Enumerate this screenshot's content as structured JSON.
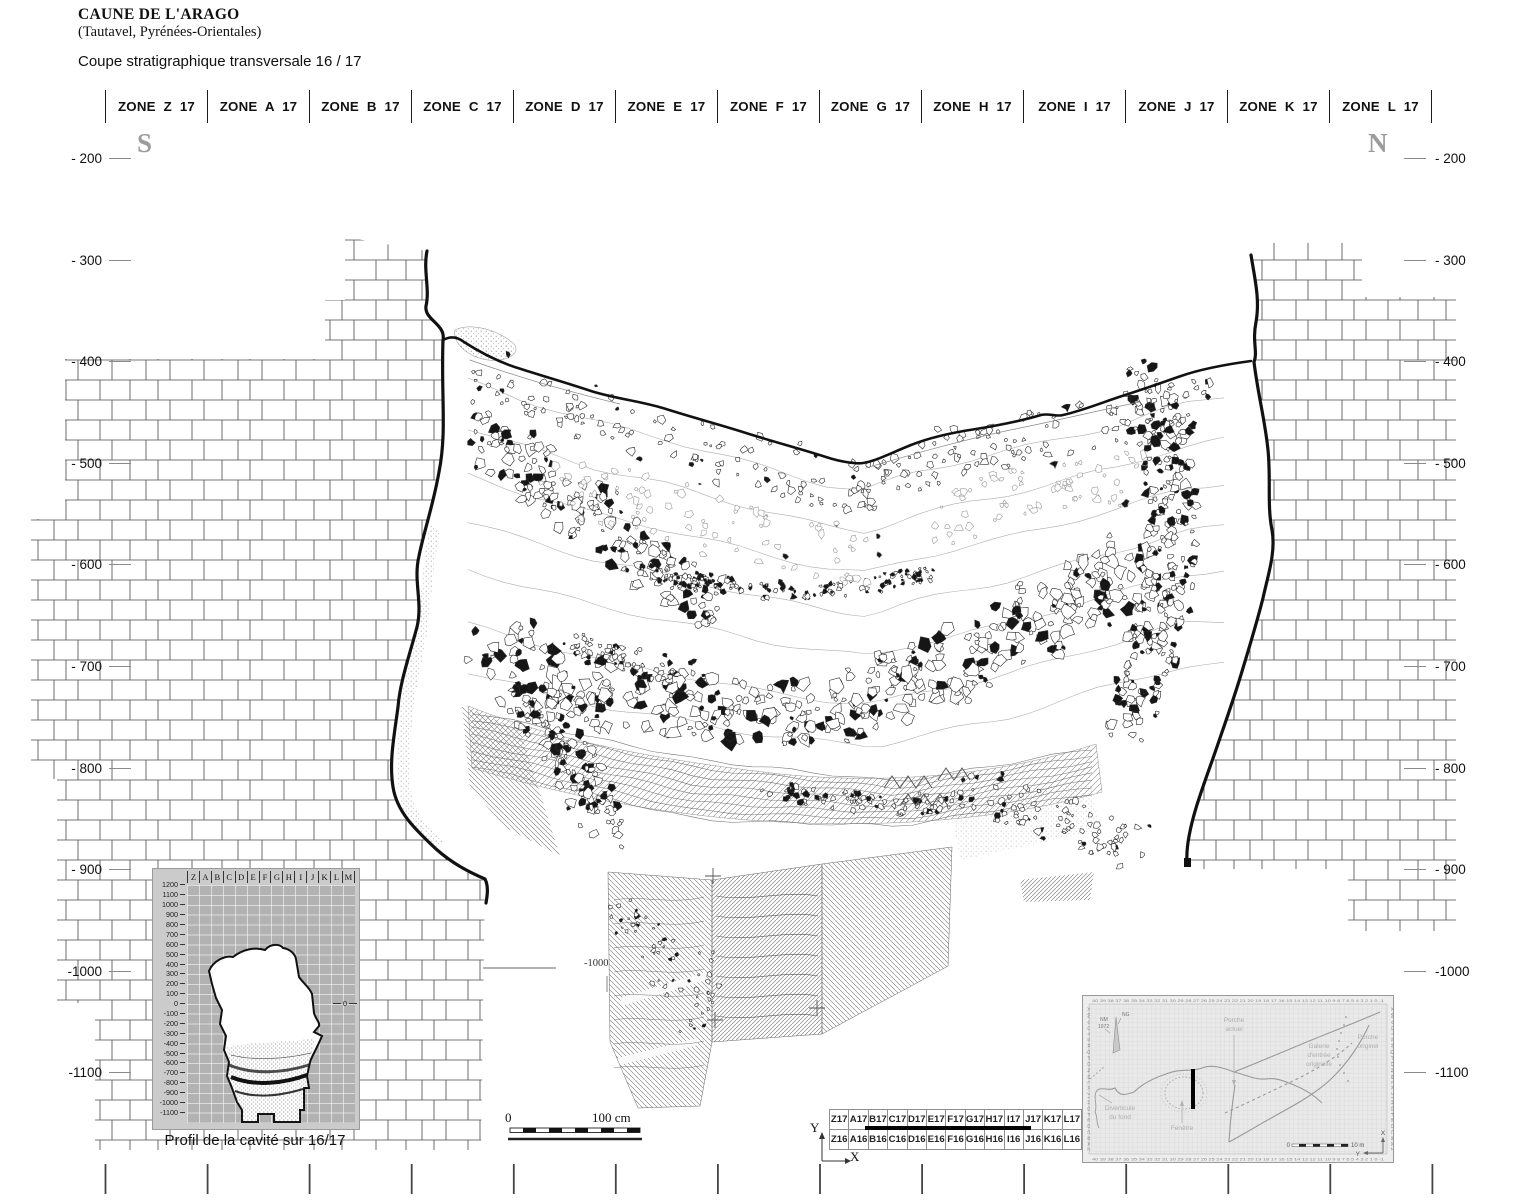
{
  "header": {
    "title": "CAUNE DE L'ARAGO",
    "subtitle": "(Tautavel, Pyrénées-Orientales)",
    "caption": "Coupe stratigraphique transversale 16 / 17"
  },
  "compass": {
    "south": "S",
    "north": "N"
  },
  "zones": [
    "ZONE Z 17",
    "ZONE A 17",
    "ZONE B 17",
    "ZONE C 17",
    "ZONE D 17",
    "ZONE E 17",
    "ZONE F 17",
    "ZONE G 17",
    "ZONE H 17",
    "ZONE I 17",
    "ZONE J 17",
    "ZONE K 17",
    "ZONE L 17"
  ],
  "depth_scale": {
    "labels": [
      "- 200",
      "- 300",
      "- 400",
      "- 500",
      "- 600",
      "- 700",
      "- 800",
      "- 900",
      "-1000",
      "-1100"
    ]
  },
  "section": {
    "inner_label": "-1000"
  },
  "profile_inset": {
    "caption": "Profil de la cavité sur 16/17",
    "column_letters": [
      "Z",
      "A",
      "B",
      "C",
      "D",
      "E",
      "F",
      "G",
      "H",
      "I",
      "J",
      "K",
      "L",
      "M"
    ],
    "row_labels": [
      "1200",
      "1100",
      "1000",
      "900",
      "800",
      "700",
      "600",
      "500",
      "400",
      "300",
      "200",
      "100",
      "0",
      "-100",
      "-200",
      "-300",
      "-400",
      "-500",
      "-600",
      "-700",
      "-800",
      "-900",
      "-1000",
      "-1100"
    ],
    "zero_marker": "0"
  },
  "scale_bar": {
    "start": "0",
    "end": "100 cm"
  },
  "grid_table": {
    "row1": [
      "Z17",
      "A17",
      "B17",
      "C17",
      "D17",
      "E17",
      "F17",
      "G17",
      "H17",
      "I17",
      "J17",
      "K17",
      "L17"
    ],
    "row2": [
      "Z16",
      "A16",
      "B16",
      "C16",
      "D16",
      "E16",
      "F16",
      "G16",
      "H16",
      "I16",
      "J16",
      "K16",
      "L16"
    ],
    "axis_x": "X",
    "axis_y": "Y"
  },
  "map_inset": {
    "porche_actuel_line1": "Porche",
    "porche_actuel_line2": "actuel",
    "galerie_line1": "Galerie",
    "galerie_line2": "d'entrée",
    "galerie_line3": "originelle",
    "porche_originel_line1": "Porche",
    "porche_originel_line2": "originel",
    "diverticule_line1": "Diverticule",
    "diverticule_line2": "du fond",
    "fenetre": "Fenêtre",
    "north_ng": "NG",
    "north_nm": "NM",
    "north_year": "1972",
    "scale_start": "0",
    "scale_end": "10 m",
    "axis_x": "X",
    "axis_y": "Y",
    "top_numbers": "40 39 38 37 36 35 34 33 32 31 30 29 28 27 26 25 24 23 22 21 20 19 18 17 16 15 14 13 12 11 10 9 8 7 6 5 4 3 2 1 0 -1",
    "side_letters": "X W V U T S R Q P O N M L K J I H G F E D C B A Z"
  },
  "colors": {
    "ink": "#111111",
    "wall_line": "#4a4a4a",
    "scale_gray": "#8a8a8a",
    "compass_gray": "#9c9c9c",
    "inset_grid_bg": "#b2b2b2",
    "map_label_gray": "#aeaeae",
    "map_line_gray": "#9a9a9a",
    "section_bar": "#000000"
  }
}
